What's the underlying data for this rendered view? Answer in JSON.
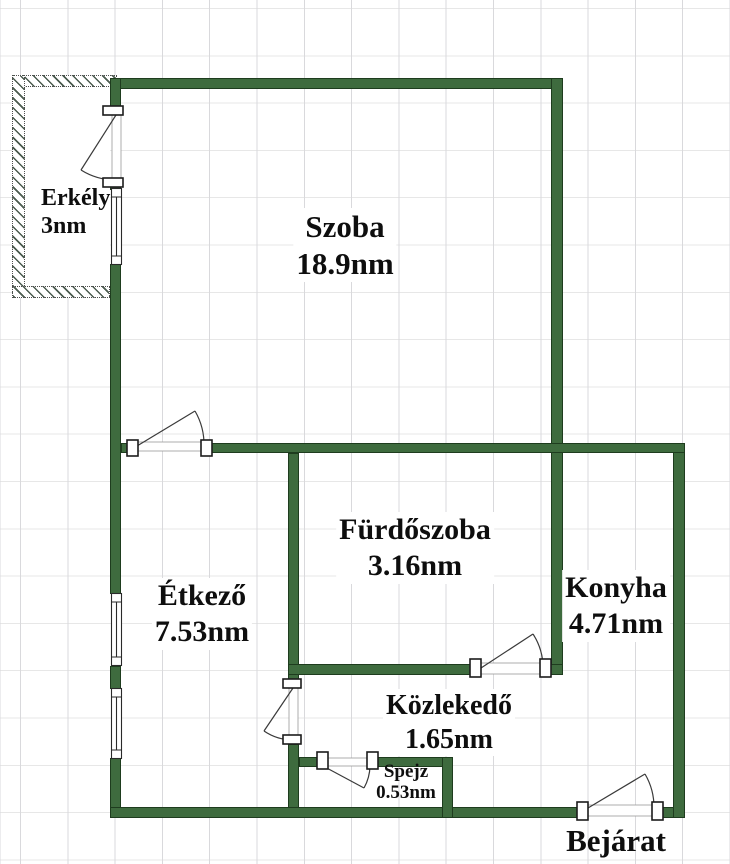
{
  "plan": {
    "rooms": [
      {
        "name": "Erkély",
        "area": "3nm"
      },
      {
        "name": "Szoba",
        "area": "18.9nm"
      },
      {
        "name": "Étkező",
        "area": "7.53nm"
      },
      {
        "name": "Fürdőszoba",
        "area": "3.16nm"
      },
      {
        "name": "Konyha",
        "area": "4.71nm"
      },
      {
        "name": "Közlekedő",
        "area": "1.65nm"
      },
      {
        "name": "Spejz",
        "area": "0.53nm"
      }
    ],
    "entrance_label": "Bejárat"
  },
  "colors": {
    "wall_fill": "#3e6b3e",
    "wall_edge": "#1e3c1e",
    "hatch": "#4a5a4e",
    "grid_vertical": "#d9d9dc",
    "grid_horizontal": "#e7e7e7",
    "label_text": "#0e0e0e",
    "symbol_stroke": "#3a3a3a"
  }
}
